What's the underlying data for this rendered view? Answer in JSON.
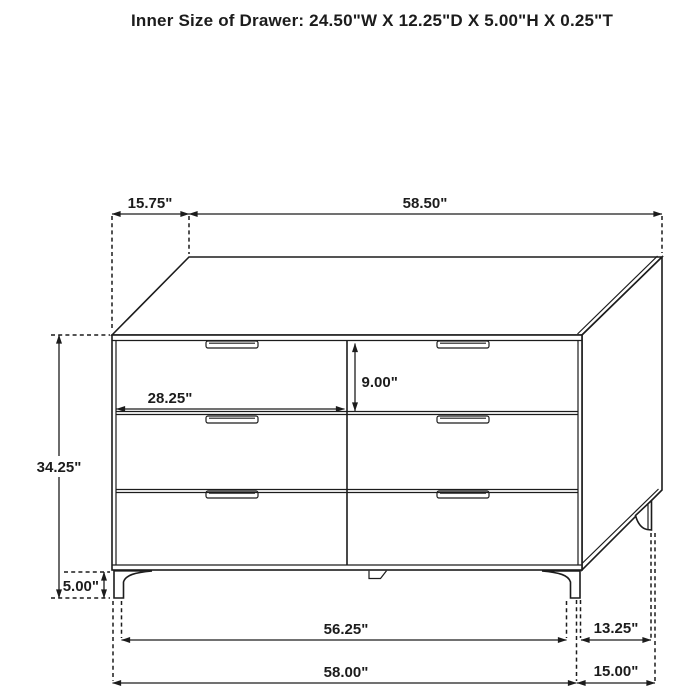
{
  "title": "Inner Size of Drawer: 24.50\"W X 12.25\"D X 5.00\"H X 0.25\"T",
  "dims": {
    "top_depth_offset": "15.75\"",
    "top_width": "58.50\"",
    "drawer_front_width": "28.25\"",
    "drawer_front_height": "9.00\"",
    "cabinet_height": "34.25\"",
    "leg_height": "5.00\"",
    "between_legs_width": "56.25\"",
    "overall_width": "58.00\"",
    "side_leg_span": "13.25\"",
    "overall_depth": "15.00\""
  },
  "colors": {
    "ink": "#1c1c1c",
    "background": "#ffffff"
  }
}
